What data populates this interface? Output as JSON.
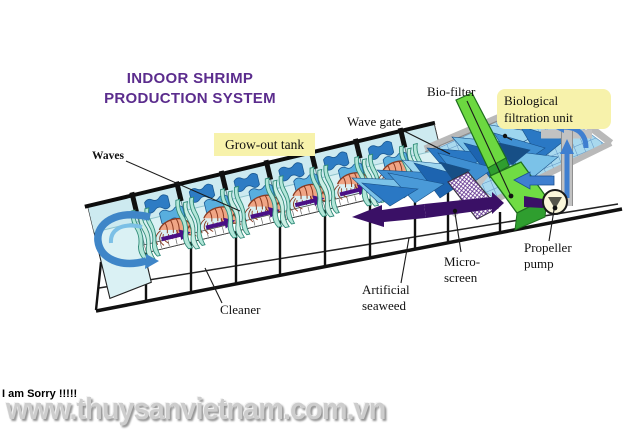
{
  "title": {
    "line1": "INDOOR SHRIMP",
    "line2": "PRODUCTION SYSTEM"
  },
  "labels": {
    "waves": "Waves",
    "grow_out_tank": "Grow-out tank",
    "wave_gate": "Wave gate",
    "bio_filter": "Bio-filter",
    "bio_unit_line1": "Biological",
    "bio_unit_line2": "filtration unit",
    "cleaner": "Cleaner",
    "artificial_line1": "Artificial",
    "artificial_line2": "seaweed",
    "micro_line1": "Micro-",
    "micro_line2": "screen",
    "propeller_line1": "Propeller",
    "propeller_line2": "pump"
  },
  "footer": {
    "sorry": "I am Sorry !!!!!",
    "watermark": "www.thuysanvietnam.com.vn"
  },
  "colors": {
    "title_purple": "#5b2c8d",
    "label_yellow": "#f7f2ab",
    "tank_cyan": "#daf1f4",
    "wave_blue": "#3f8fd2",
    "arrow_purple": "#4a1086",
    "biofilter_green": "#6cd840",
    "shrimp_salmon": "#f0a585",
    "seaweed_teal": "#b2e6d8",
    "watermark_gray": "#cdcdcd"
  }
}
